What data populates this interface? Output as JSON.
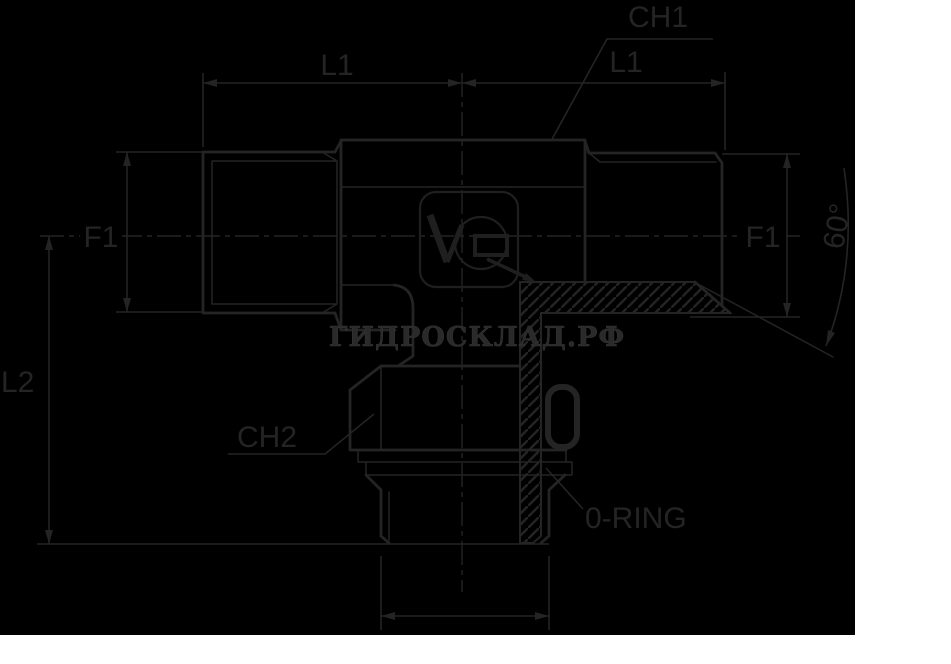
{
  "drawing": {
    "kind": "technical-drawing",
    "subject": "tee adapter fitting, front view with half section"
  },
  "colors": {
    "page_background": "#ffffff",
    "drawing_background": "#000000",
    "line_color": "#242424",
    "watermark_color": "#2a2a2a"
  },
  "labels": {
    "ch1": "CH1",
    "l1_left": "L1",
    "l1_right": "L1",
    "f1_left": "F1",
    "f1_right": "F1",
    "l2": "L2",
    "ch2": "CH2",
    "oring": "0-RING",
    "cone_angle": "60°"
  },
  "watermark": {
    "text": "ГИДРОСКЛАД.РФ"
  }
}
